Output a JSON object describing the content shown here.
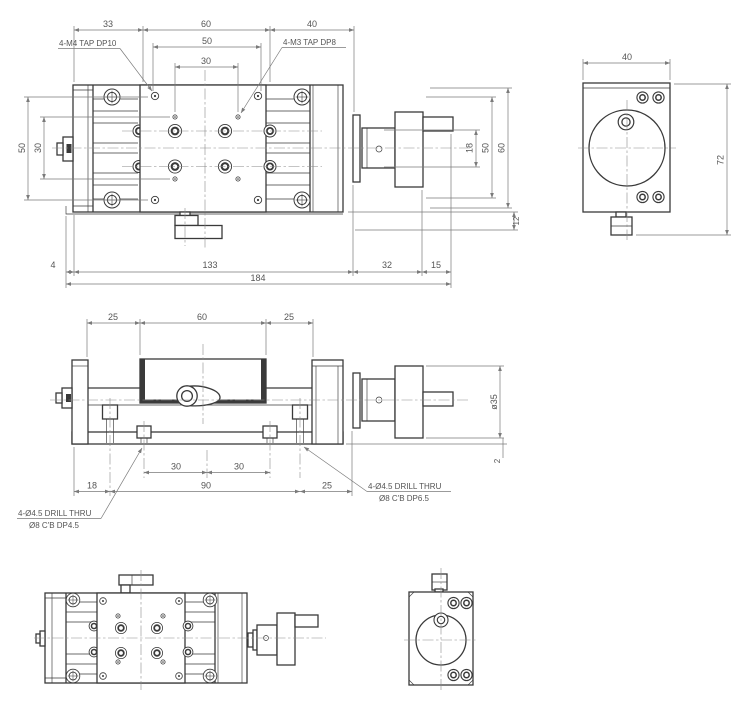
{
  "drawing": {
    "background": "#ffffff",
    "line_color": "#3a3a3a",
    "dim_line_color": "#7a7a7a",
    "text_color": "#555555"
  },
  "views": {
    "plan": {
      "dim_33": "33",
      "dim_60_top": "60",
      "dim_40": "40",
      "dim_50_holes": "50",
      "dim_30_holes": "30",
      "label_tap_m4": "4-M4 TAP DP10",
      "label_tap_m3": "4-M3 TAP DP8",
      "dim_50_left": "50",
      "dim_30_left": "30",
      "dim_18_right": "18",
      "dim_50_right": "50",
      "dim_60_right": "60",
      "dim_12_right": "12",
      "dim_4": "4",
      "dim_133": "133",
      "dim_32": "32",
      "dim_15": "15",
      "dim_184": "184"
    },
    "side": {
      "dim_25_left": "25",
      "dim_60_top": "60",
      "dim_25_right": "25",
      "dim_dia_35": "ø35",
      "dim_2": "2",
      "dim_30_a": "30",
      "dim_30_b": "30",
      "dim_18": "18",
      "dim_90": "90",
      "dim_25_bottom": "25",
      "label_drill_left_1": "4-Ø4.5 DRILL THRU",
      "label_drill_left_2": "Ø8 C'B DP4.5",
      "label_drill_right_1": "4-Ø4.5 DRILL THRU",
      "label_drill_right_2": "Ø8 C'B DP6.5"
    },
    "end_top_right": {
      "dim_40": "40",
      "dim_72": "72"
    }
  }
}
